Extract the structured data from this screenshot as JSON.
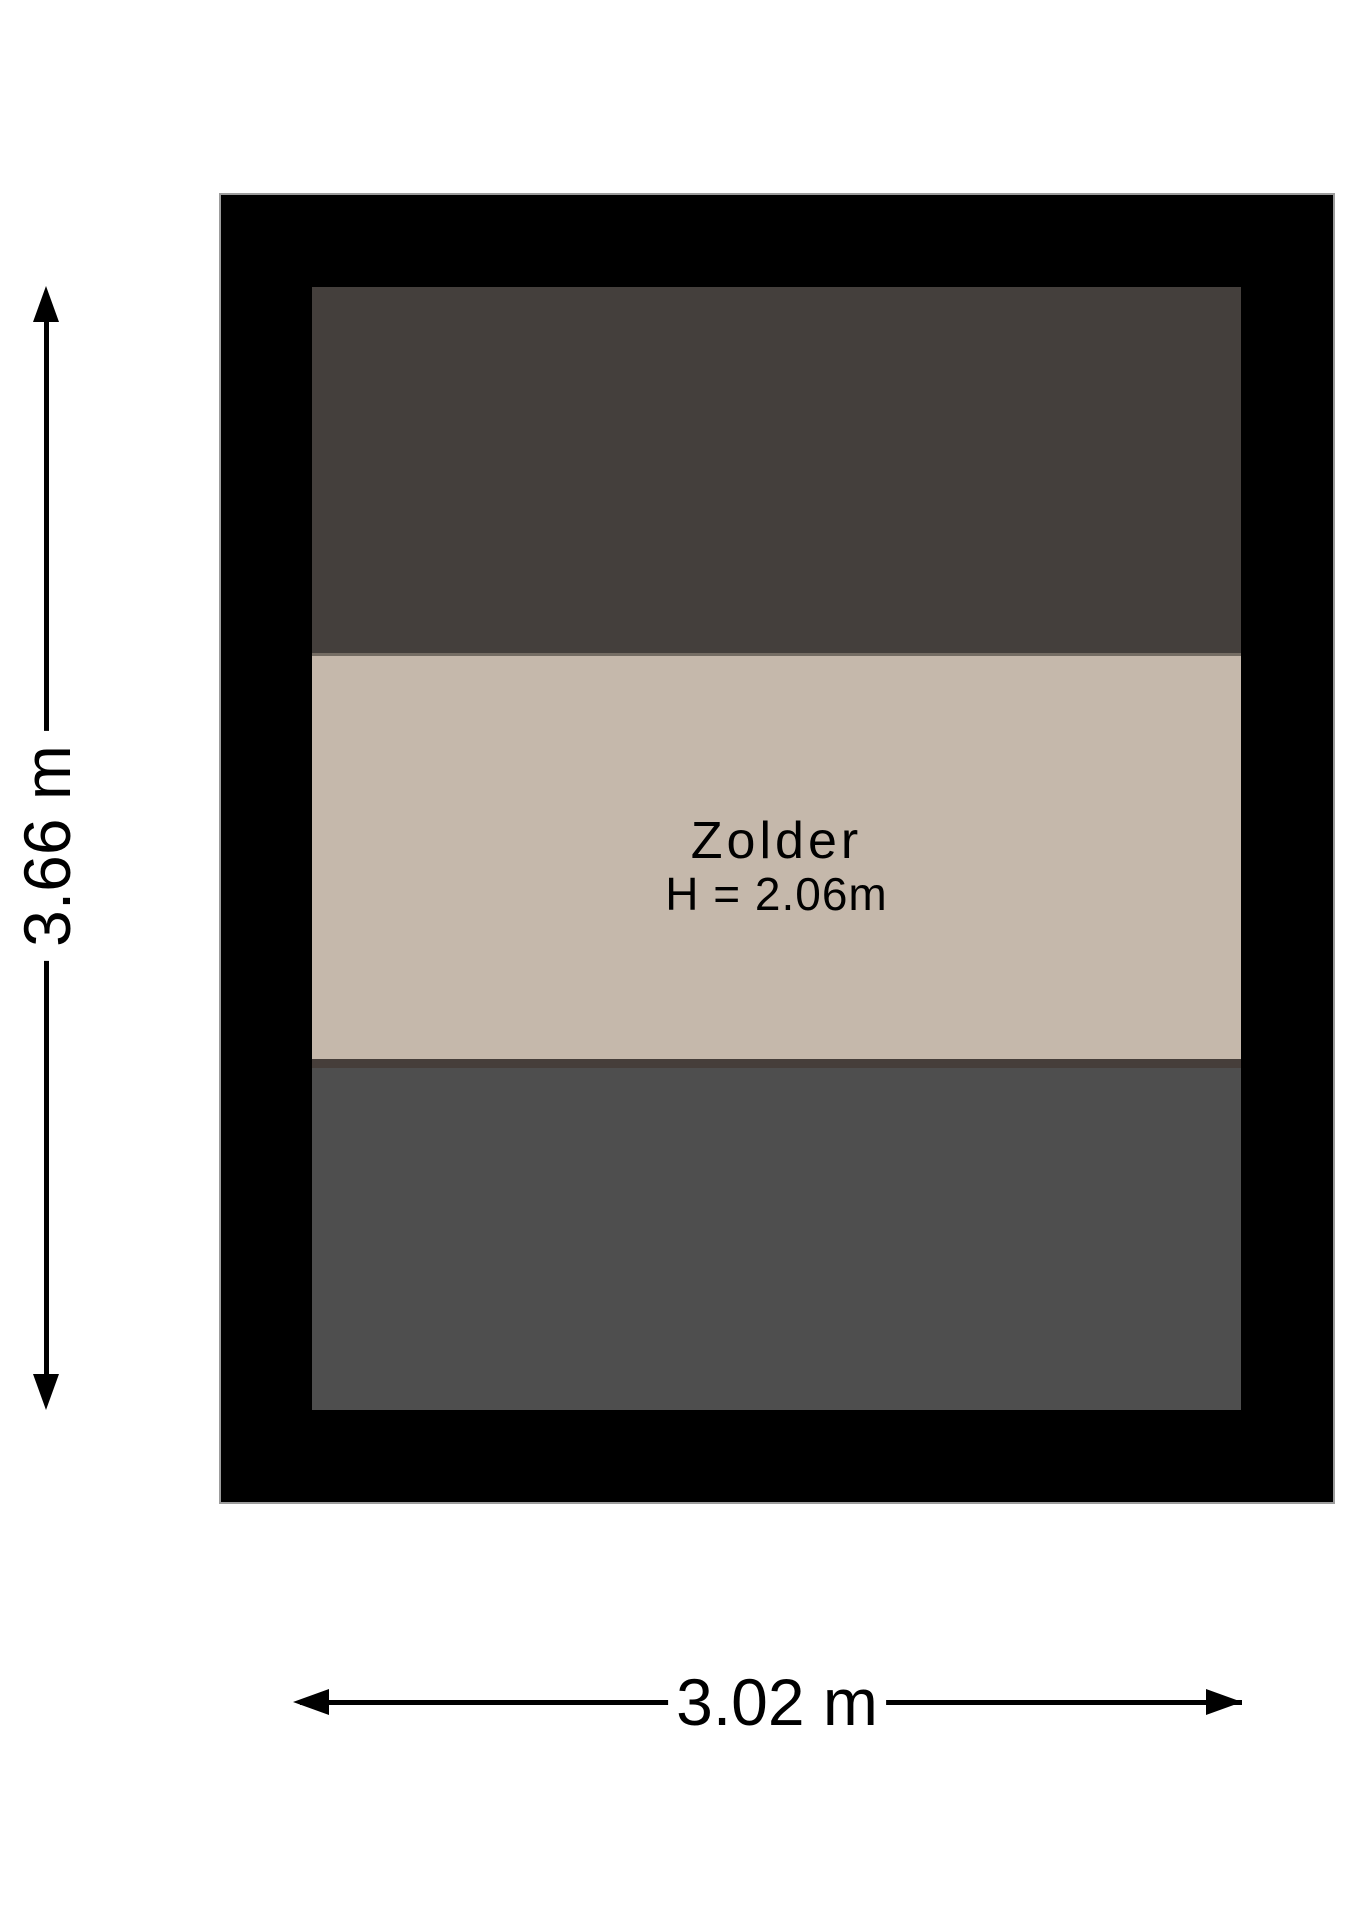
{
  "floorplan": {
    "room": {
      "name": "Zolder",
      "ceiling_height": "H = 2.06m"
    },
    "dimensions": {
      "vertical": "3.66 m",
      "horizontal": "3.02 m"
    },
    "colors": {
      "wall": "#000000",
      "wall_outline": "#9c9c9c",
      "sloped_area_top": "#443f3c",
      "ridge_line": "#756d64",
      "floor_area": "#c5b8ab",
      "beam_line": "#463e3a",
      "sloped_area_bottom": "#4e4e4e",
      "dimension_lines": "#000000"
    }
  }
}
